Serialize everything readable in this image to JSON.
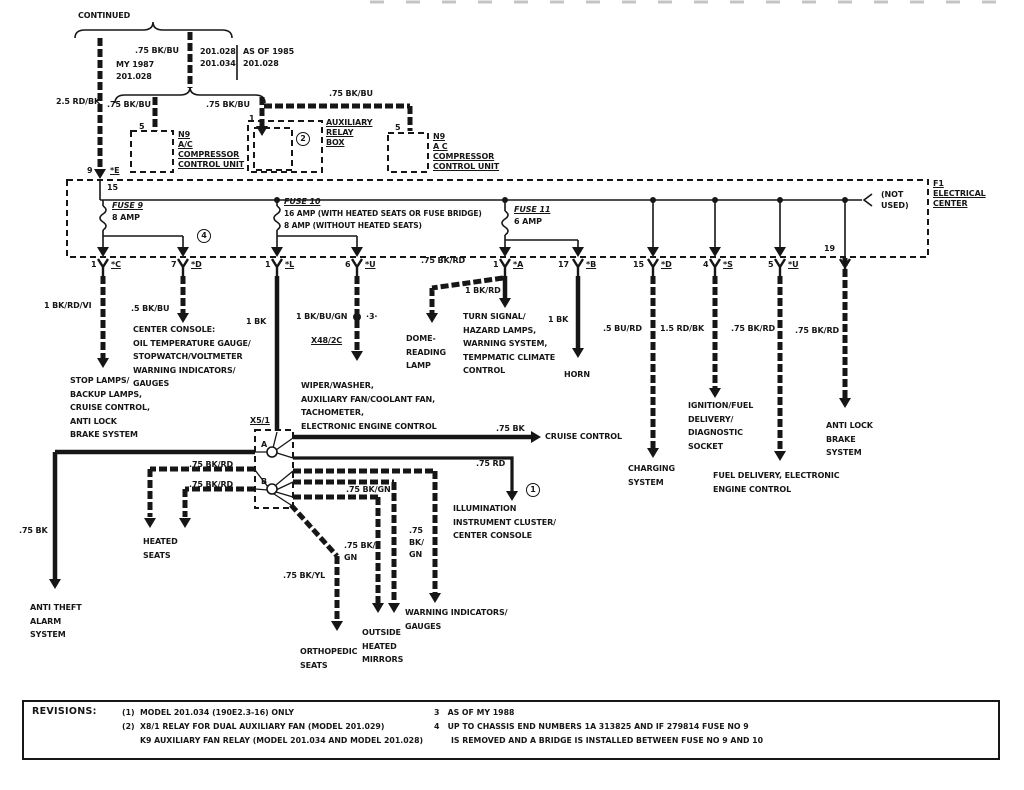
{
  "top": {
    "continued": "CONTINUED",
    "my_model": "MY 1987\n201.028",
    "ver_left": "201.028\n201.034",
    "ver_right": "AS OF 1985\n201.028",
    "wire_25_rd_bk": "2.5 RD/BK",
    "wire_75_bk_bu": ".75 BK/BU",
    "pin_5": "5",
    "pin_1": "1",
    "pin_9": "9",
    "conn_e": "*E",
    "n9_left": "N9\nA/C\nCOMPRESSOR\nCONTROL UNIT",
    "aux_relay_box": "AUXILIARY\nRELAY\nBOX",
    "n9_right": "N9\nA C\nCOMPRESSOR\nCONTROL UNIT",
    "note_2": "2"
  },
  "center": {
    "f1": "F1\nELECTRICAL\nCENTER",
    "not_used": "(NOT\nUSED)",
    "terminal_15": "15",
    "pin_19": "19",
    "note_4": "4",
    "fuse9": {
      "name": "FUSE 9",
      "amp": "8 AMP"
    },
    "fuse10": {
      "name": "FUSE 10",
      "amp1": "16 AMP (WITH HEATED SEATS OR FUSE BRIDGE)",
      "amp2": "8 AMP (WITHOUT HEATED SEATS)"
    },
    "fuse11": {
      "name": "FUSE 11",
      "amp": "6 AMP"
    },
    "connectors": [
      {
        "pin": "1",
        "code": "*C"
      },
      {
        "pin": "7",
        "code": "*D"
      },
      {
        "pin": "1",
        "code": "*L"
      },
      {
        "pin": "6",
        "code": "*U"
      },
      {
        "pin": "1",
        "code": "*A"
      },
      {
        "pin": "17",
        "code": "*B"
      },
      {
        "pin": "15",
        "code": "*D"
      },
      {
        "pin": "4",
        "code": "*S"
      },
      {
        "pin": "5",
        "code": "*U"
      }
    ]
  },
  "wires": {
    "bk_rd_vi": "1 BK/RD/VI",
    "bk_bu_5": ".5 BK/BU",
    "bk_1": "1 BK",
    "bk_bu_gn": "1 BK/BU/GN",
    "note_3": "·3·",
    "x48": "X48/2C",
    "bk_rd_75": ".75 BK/RD",
    "bk_rd_1": "1 BK/RD",
    "bu_rd_5": ".5 BU/RD",
    "rd_bk_15": "1.5 RD/BK",
    "bk_75": ".75 BK",
    "rd_75": ".75 RD",
    "bk_gn_75": ".75 BK/GN",
    "bk_gn_75_2l": ".75 BK/\nGN",
    "bk_gn_75_3l": ".75\nBK/\nGN",
    "bk_yl_75": ".75 BK/YL",
    "note_1": "1"
  },
  "loads": {
    "stop_lamps": "STOP LAMPS/\nBACKUP LAMPS,\nCRUISE CONTROL,\nANTI LOCK\nBRAKE SYSTEM",
    "center_console": "CENTER CONSOLE:\nOIL TEMPERATURE GAUGE/\nSTOPWATCH/VOLTMETER\nWARNING INDICATORS/\nGAUGES",
    "wiper": "WIPER/WASHER,\nAUXILIARY FAN/COOLANT FAN,\nTACHOMETER,\nELECTRONIC ENGINE CONTROL",
    "dome": "DOME-\nREADING\nLAMP",
    "turn_signal": "TURN SIGNAL/\nHAZARD LAMPS,\nWARNING SYSTEM,\nTEMPMATIC CLIMATE\nCONTROL",
    "horn": "HORN",
    "charging": "CHARGING\nSYSTEM",
    "ignition": "IGNITION/FUEL\nDELIVERY/\nDIAGNOSTIC\nSOCKET",
    "fuel_delivery": "FUEL DELIVERY, ELECTRONIC\nENGINE CONTROL",
    "abs_right": "ANTI LOCK\nBRAKE\nSYSTEM",
    "cruise": "CRUISE CONTROL",
    "illumination": "ILLUMINATION\nINSTRUMENT CLUSTER/\nCENTER CONSOLE",
    "warning": "WARNING INDICATORS/\nGAUGES",
    "mirrors": "OUTSIDE\nHEATED\nMIRRORS",
    "orthopedic": "ORTHOPEDIC\nSEATS",
    "heated_seats": "HEATED\nSEATS",
    "anti_theft": "ANTI THEFT\nALARM\nSYSTEM"
  },
  "x5": {
    "label": "X5/1",
    "a": "A",
    "b": "B"
  },
  "revisions": {
    "title": "REVISIONS:",
    "r1": "(1)  MODEL 201.034 (190E2.3-16) ONLY",
    "r2": "(2)  X8/1 RELAY FOR DUAL AUXILIARY FAN (MODEL 201.029)",
    "r2b": "K9 AUXILIARY FAN RELAY (MODEL 201.034 AND MODEL 201.028)",
    "r3": "3   AS OF MY 1988",
    "r4": "4   UP TO CHASSIS END NUMBERS 1A 313825 AND IF 279814 FUSE NO 9",
    "r4b": "IS REMOVED AND A BRIDGE IS INSTALLED BETWEEN FUSE NO 9 AND 10"
  }
}
